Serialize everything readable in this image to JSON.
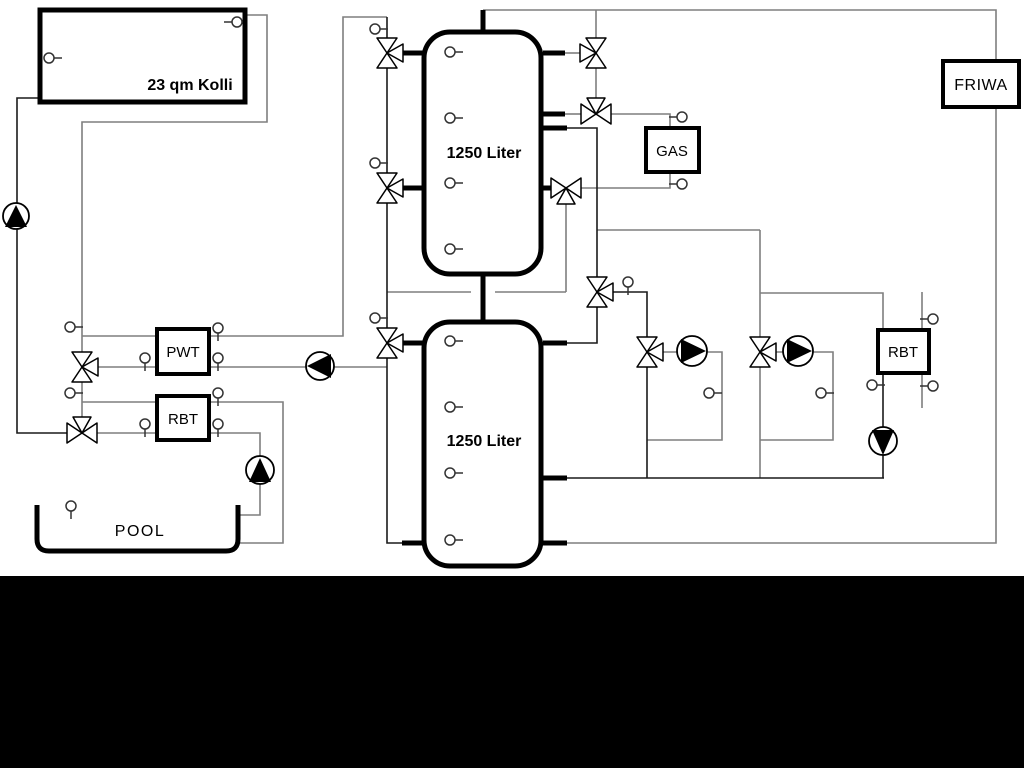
{
  "labels": {
    "collector": "23 qm Kolli",
    "tank_upper": "1250 Liter",
    "tank_lower": "1250 Liter",
    "gas": "GAS",
    "friwa": "FRIWA",
    "pwt": "PWT",
    "rbt_left": "RBT",
    "rbt_right": "RBT",
    "pool": "POOL"
  },
  "colors": {
    "pipe_gray": "#7f7f7f",
    "pipe_dark": "#1a1a1a",
    "background": "#ffffff",
    "bottom_bar": "#000000"
  }
}
